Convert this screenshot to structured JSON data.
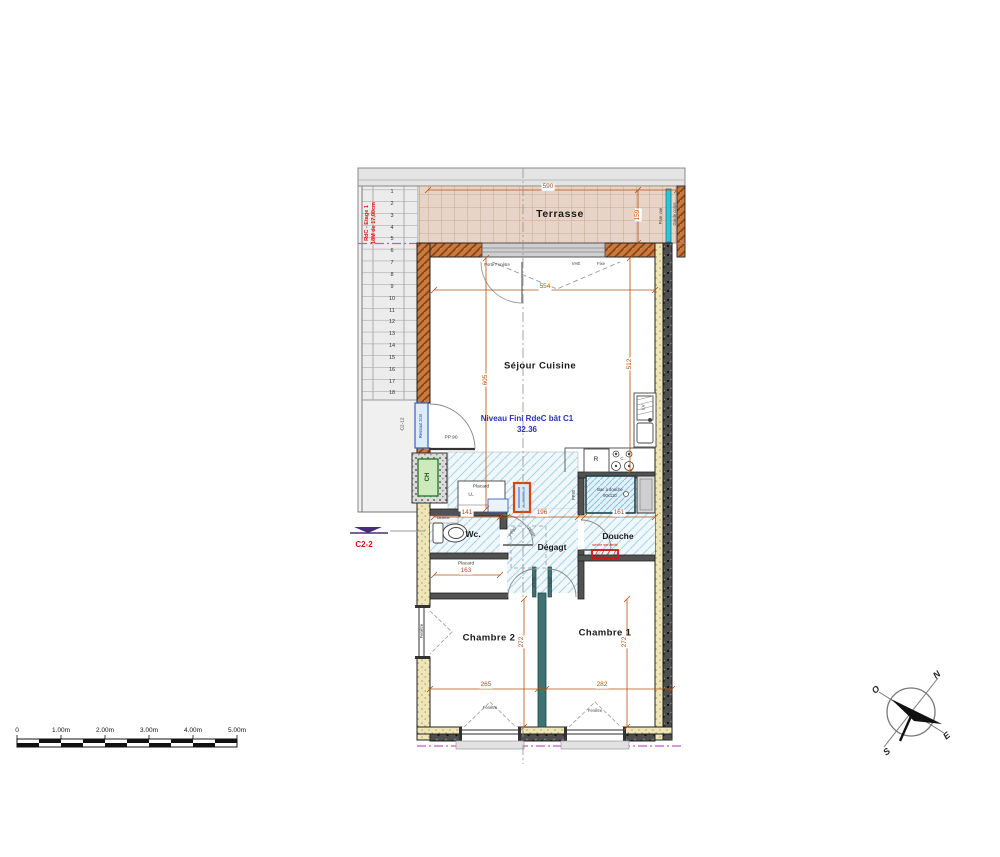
{
  "plan": {
    "rooms": {
      "terrasse": "Terrasse",
      "sejour_cuisine": "Séjour Cuisine",
      "wc": "Wc.",
      "degagement": "Dégagt",
      "douche": "Douche",
      "placard": "Placard",
      "placard_ll": "LL",
      "chambre_1": "Chambre 1",
      "chambre_2": "Chambre 2"
    },
    "annotations": {
      "niveau_line1": "Niveau Fini RdeC bât C1",
      "niveau_value": "32.36",
      "stair_line1": "RdC - Etage 1",
      "stair_line2": "18M de 17,00cm",
      "section_c2_2": "C2-2",
      "section_c2_12": "C2-12",
      "ressaut": "Ressaut 2cm",
      "pare_vue": "Pare vue",
      "garde_corps": "Garde corps",
      "porte_fenetre": "Porte Fenêtre",
      "vhe": "VHE",
      "fixe": "Fixe",
      "pp90": "PP 90",
      "pp80": "PP80",
      "ch": "CH",
      "lv": "LV",
      "refrigerator": "R",
      "cooktop": "C.",
      "bac_douche_line1": "Bac à douche",
      "bac_douche_line2": "90x120",
      "tablette": "Tablette",
      "seche_serviette": "sèche serviette",
      "fenetre": "Fenêtre"
    },
    "dimensions": {
      "terrasse_width": "590",
      "terrasse_depth": "159",
      "sejour_width": "554",
      "left_height": "605",
      "right_height": "512",
      "wc_width": "141",
      "degagement_width": "196",
      "douche_width": "161",
      "placard_width": "163",
      "chambre2_width": "265",
      "chambre1_width": "282",
      "chambre_depth": "272"
    },
    "stairs": {
      "steps": [
        "1",
        "2",
        "3",
        "4",
        "5",
        "6",
        "7",
        "8",
        "9",
        "10",
        "11",
        "12",
        "13",
        "14",
        "15",
        "16",
        "17",
        "18"
      ]
    },
    "compass": {
      "north": "N",
      "south": "S",
      "east": "E",
      "west": "O"
    },
    "scale_bar": {
      "labels": [
        "0",
        "1.00m",
        "2.00m",
        "3.00m",
        "4.00m",
        "5.00m"
      ]
    },
    "colors": {
      "dimension_orange": "#b5500f",
      "annotation_red": "#dd1111",
      "annotation_blue": "#2233bb",
      "axis_magenta": "#cc55cc",
      "wall_insulation_yellow": "#eee6b8",
      "wall_brown": "#c87a40",
      "floor_tile_blue": "#eef7fb",
      "terrace_tile": "#e8d4c6",
      "cyan_screen": "#35c2d8",
      "divider_teal": "#3f7272",
      "ch_green": "#cdeabc"
    }
  }
}
